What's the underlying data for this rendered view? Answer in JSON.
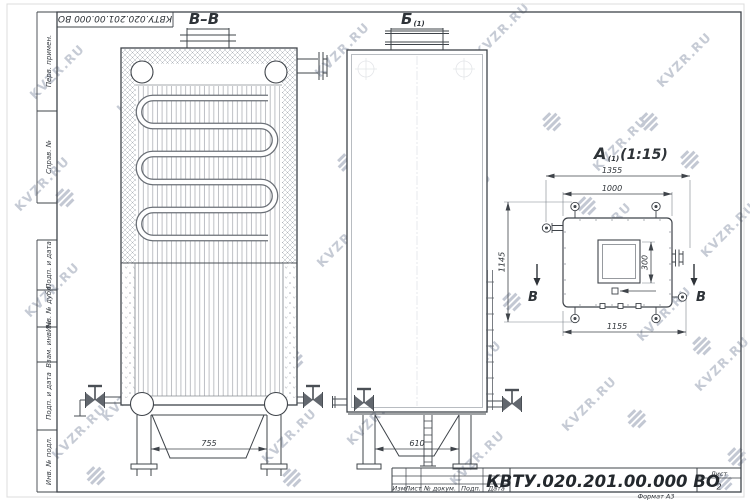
{
  "watermark": {
    "text": "KVZR.RU"
  },
  "frame": {
    "designation_rotated": "КВТУ.020.201.00.000 ВО",
    "fields": [
      "Перв. примен.",
      "Справ. №",
      "Подп. и дата",
      "Инв. № дубл.",
      "Взам. инв. №",
      "Подп. и дата",
      "Инв. № подл."
    ]
  },
  "views": {
    "section_bb": {
      "label": "В–В",
      "dim_legs": "755"
    },
    "side_b": {
      "label": "Б",
      "sub": "(1)",
      "dim_legs": "610"
    },
    "top_a": {
      "label": "А",
      "sub": "(1)",
      "scale": "(1:15)",
      "dim_overall_width": "1355",
      "dim_body_width": "1000",
      "dim_depth": "1145",
      "dim_base": "1155",
      "dim_opening": "300",
      "section_mark": "В"
    }
  },
  "title_block": {
    "designation": "КВТУ.020.201.00.000 ВО",
    "columns": [
      "Изм",
      "Лист",
      "№ докум.",
      "Подп.",
      "Дата"
    ],
    "sheet_label": "Лист",
    "sheet_number": "2",
    "format_note": "Формат А3"
  }
}
